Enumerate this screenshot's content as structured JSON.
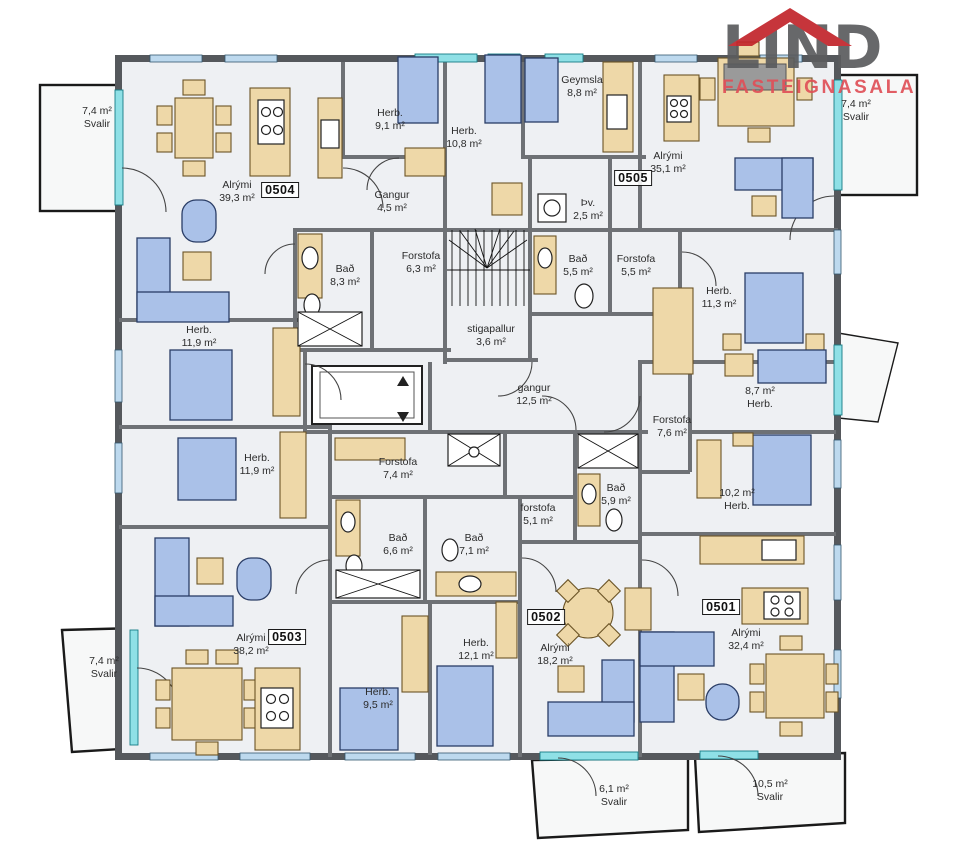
{
  "logo": {
    "word": "LIND",
    "tagline": "FASTEIGNASALA"
  },
  "colors": {
    "wall_exterior": "#55585c",
    "wall_interior": "#6e7175",
    "glass": "#8fe0e6",
    "window": "#bdd9ee",
    "furniture_wood": "#eed8a8",
    "furniture_upholstery": "#aac1e8",
    "room_fill": "#eef0f3",
    "balcony_fill": "#f7f8f8",
    "logo_red": "#c2242b",
    "logo_text_red": "#e05058",
    "logo_gray": "#5b5c5e"
  },
  "units": [
    {
      "id": "0504",
      "x": 280,
      "y": 190
    },
    {
      "id": "0505",
      "x": 633,
      "y": 178
    },
    {
      "id": "0503",
      "x": 287,
      "y": 637
    },
    {
      "id": "0502",
      "x": 546,
      "y": 617
    },
    {
      "id": "0501",
      "x": 721,
      "y": 607
    }
  ],
  "labels": [
    {
      "lines": [
        "7,4 m²",
        "Svalir"
      ],
      "x": 97,
      "y": 118
    },
    {
      "lines": [
        "Alrými",
        "39,3 m²"
      ],
      "x": 237,
      "y": 192
    },
    {
      "lines": [
        "Herb.",
        "9,1 m²"
      ],
      "x": 390,
      "y": 120
    },
    {
      "lines": [
        "Herb.",
        "10,8 m²"
      ],
      "x": 464,
      "y": 138
    },
    {
      "lines": [
        "Gangur",
        "4,5 m²"
      ],
      "x": 392,
      "y": 202
    },
    {
      "lines": [
        "Geymsla",
        "8,8 m²"
      ],
      "x": 582,
      "y": 87
    },
    {
      "lines": [
        "Alrými",
        "35,1 m²"
      ],
      "x": 668,
      "y": 163
    },
    {
      "lines": [
        "7,4 m²",
        "Svalir"
      ],
      "x": 856,
      "y": 111
    },
    {
      "lines": [
        "Þv.",
        "2,5 m²"
      ],
      "x": 588,
      "y": 210
    },
    {
      "lines": [
        "Bað",
        "8,3 m²"
      ],
      "x": 345,
      "y": 276
    },
    {
      "lines": [
        "Forstofa",
        "6,3 m²"
      ],
      "x": 421,
      "y": 263
    },
    {
      "lines": [
        "Bað",
        "5,5 m²"
      ],
      "x": 578,
      "y": 266
    },
    {
      "lines": [
        "Forstofa",
        "5,5 m²"
      ],
      "x": 636,
      "y": 266
    },
    {
      "lines": [
        "stigapallur",
        "3,6 m²"
      ],
      "x": 491,
      "y": 336
    },
    {
      "lines": [
        "Herb.",
        "11,3 m²"
      ],
      "x": 719,
      "y": 298
    },
    {
      "lines": [
        "Herb.",
        "11,9 m²"
      ],
      "x": 199,
      "y": 337
    },
    {
      "lines": [
        "gangur",
        "12,5 m²"
      ],
      "x": 534,
      "y": 395
    },
    {
      "lines": [
        "8,7 m²",
        "Herb."
      ],
      "x": 760,
      "y": 398
    },
    {
      "lines": [
        "Forstofa",
        "7,6 m²"
      ],
      "x": 672,
      "y": 427
    },
    {
      "lines": [
        "Herb.",
        "11,9 m²"
      ],
      "x": 257,
      "y": 465
    },
    {
      "lines": [
        "Forstofa",
        "7,4 m²"
      ],
      "x": 398,
      "y": 469
    },
    {
      "lines": [
        "Bað",
        "6,6 m²"
      ],
      "x": 398,
      "y": 545
    },
    {
      "lines": [
        "Bað",
        "7,1 m²"
      ],
      "x": 474,
      "y": 545
    },
    {
      "lines": [
        "forstofa",
        "5,1 m²"
      ],
      "x": 538,
      "y": 515
    },
    {
      "lines": [
        "Bað",
        "5,9 m²"
      ],
      "x": 616,
      "y": 495
    },
    {
      "lines": [
        "10,2 m²",
        "Herb."
      ],
      "x": 737,
      "y": 500
    },
    {
      "lines": [
        "Alrými",
        "38,2 m²"
      ],
      "x": 251,
      "y": 645
    },
    {
      "lines": [
        "7,4 m²",
        "Svalir"
      ],
      "x": 104,
      "y": 668
    },
    {
      "lines": [
        "Herb.",
        "12,1 m²"
      ],
      "x": 476,
      "y": 650
    },
    {
      "lines": [
        "Herb.",
        "9,5 m²"
      ],
      "x": 378,
      "y": 699
    },
    {
      "lines": [
        "Alrými",
        "18,2 m²"
      ],
      "x": 555,
      "y": 655
    },
    {
      "lines": [
        "Alrými",
        "32,4 m²"
      ],
      "x": 746,
      "y": 640
    },
    {
      "lines": [
        "6,1 m²",
        "Svalir"
      ],
      "x": 614,
      "y": 796
    },
    {
      "lines": [
        "10,5 m²",
        "Svalir"
      ],
      "x": 770,
      "y": 791
    }
  ]
}
